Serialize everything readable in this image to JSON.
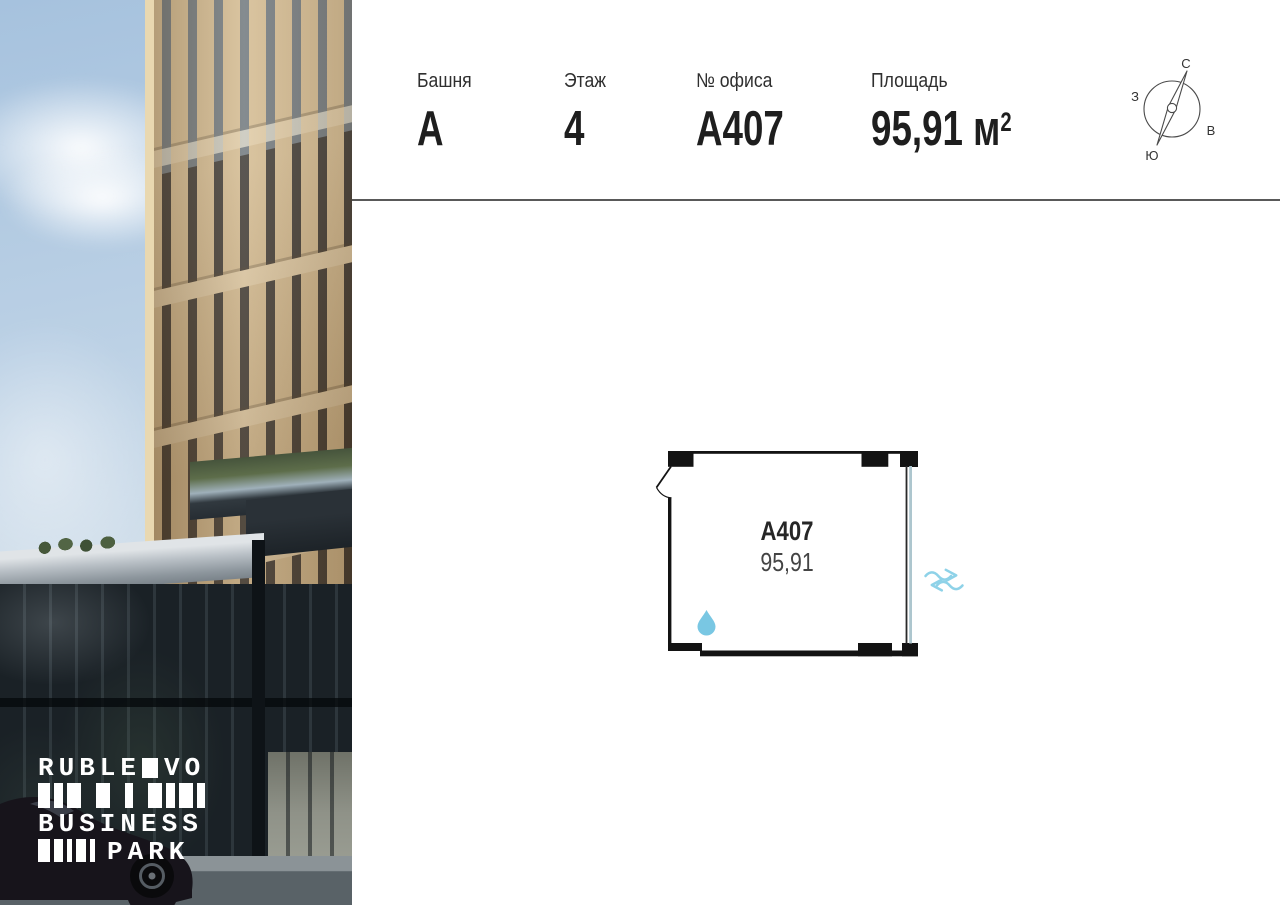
{
  "header": {
    "columns": [
      {
        "label": "Башня",
        "value": "A"
      },
      {
        "label": "Этаж",
        "value": "4"
      },
      {
        "label": "№ офиса",
        "value": "A407"
      },
      {
        "label": "Площадь",
        "value": "95,91 м",
        "sup": "2"
      }
    ]
  },
  "compass": {
    "north": "С",
    "east": "В",
    "south": "Ю",
    "west": "З"
  },
  "plan": {
    "unit_number": "A407",
    "area": "95,91"
  },
  "logo": {
    "word1": "RUBLE",
    "word2": "VO",
    "word3": "BUSINESS",
    "word4": "PARK"
  },
  "icons": {
    "water": "water-drop-icon",
    "vent": "air-flow-icon",
    "compass": "compass-icon"
  },
  "colors": {
    "accent_blue": "#79c7e3",
    "vent_blue": "#8ed2e8",
    "wall": "#131313",
    "rule_gray": "#595959"
  }
}
